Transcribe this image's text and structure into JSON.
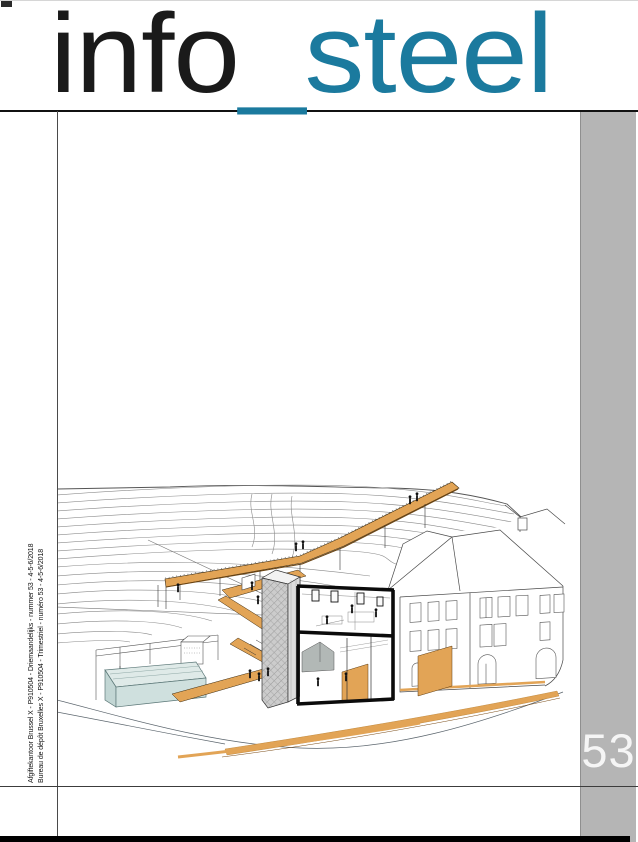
{
  "page": {
    "type": "magazine cover",
    "publication": "info_steel"
  },
  "masthead": {
    "word_black": "info",
    "word_accent": "_steel"
  },
  "issue": {
    "number": "53"
  },
  "spine": {
    "line1": "Afgiftekantoor Brussel X - P910504 - Driemaandelijks - nummer 53 - 4-5-6/2018",
    "line2": "Bureau de dépôt Bruxelles X - P910504 - Trimestriel - numéro 53 - 4-5-6/2018"
  },
  "illustration": {
    "subject": "axonometric architectural site drawing with sectioned building, walkways, hillside contours and water basin",
    "colors": {
      "accent_teal": "#1b7a9e",
      "band_gray": "#b5b5b5",
      "issue_number_white": "#f5f5f5",
      "walkway_orange": "#e2a456",
      "walkway_shadow": "#6b4412",
      "water_teal": "#d2e2e0",
      "tower_gray": "#cccccc",
      "line_gray": "#555555"
    }
  }
}
